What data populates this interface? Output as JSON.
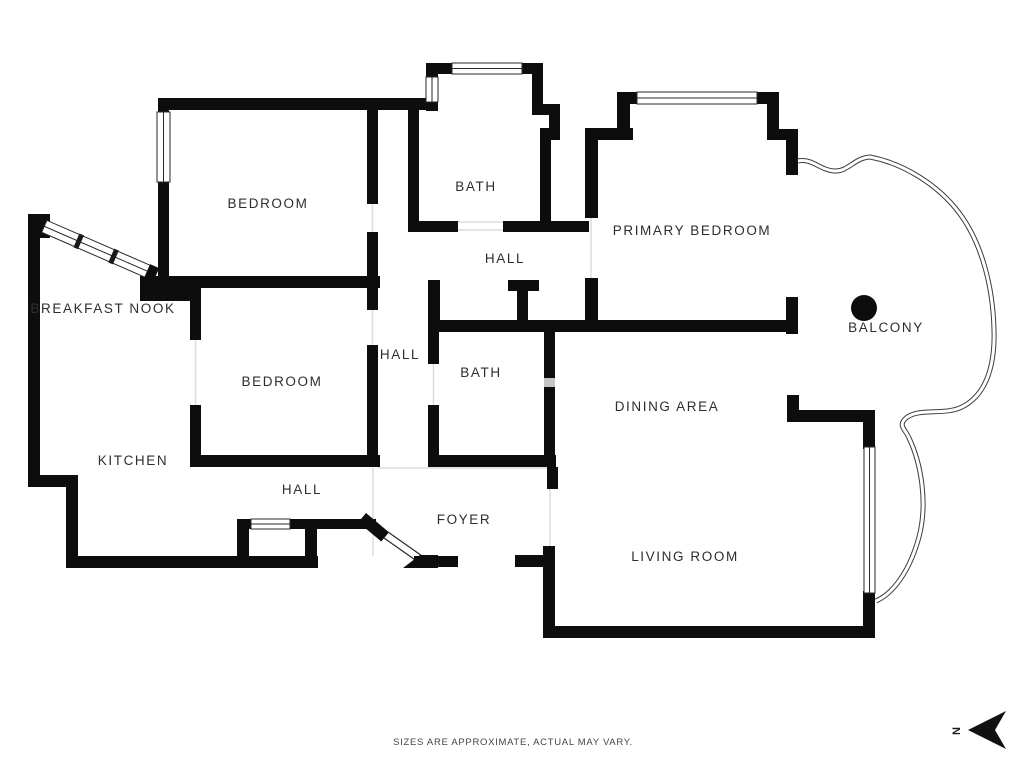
{
  "rooms": {
    "bedroom_top": {
      "label": "BEDROOM"
    },
    "bath_top": {
      "label": "BATH"
    },
    "hall_upper": {
      "label": "HALL"
    },
    "primary_bedroom": {
      "label": "PRIMARY BEDROOM"
    },
    "balcony": {
      "label": "BALCONY"
    },
    "breakfast_nook": {
      "label": "BREAKFAST NOOK"
    },
    "bedroom_mid": {
      "label": "BEDROOM"
    },
    "hall_mid": {
      "label": "HALL"
    },
    "bath_mid": {
      "label": "BATH"
    },
    "kitchen": {
      "label": "KITCHEN"
    },
    "hall_lower": {
      "label": "HALL"
    },
    "foyer": {
      "label": "FOYER"
    },
    "dining_area": {
      "label": "DINING AREA"
    },
    "living_room": {
      "label": "LIVING ROOM"
    }
  },
  "compass": {
    "label": "N"
  },
  "footer": {
    "disclaimer": "SIZES ARE APPROXIMATE, ACTUAL MAY VARY."
  },
  "colors": {
    "wall": "#0d0d0d",
    "label": "#2e2e2e",
    "railing": "#3d3d3d",
    "background": "#ffffff"
  }
}
